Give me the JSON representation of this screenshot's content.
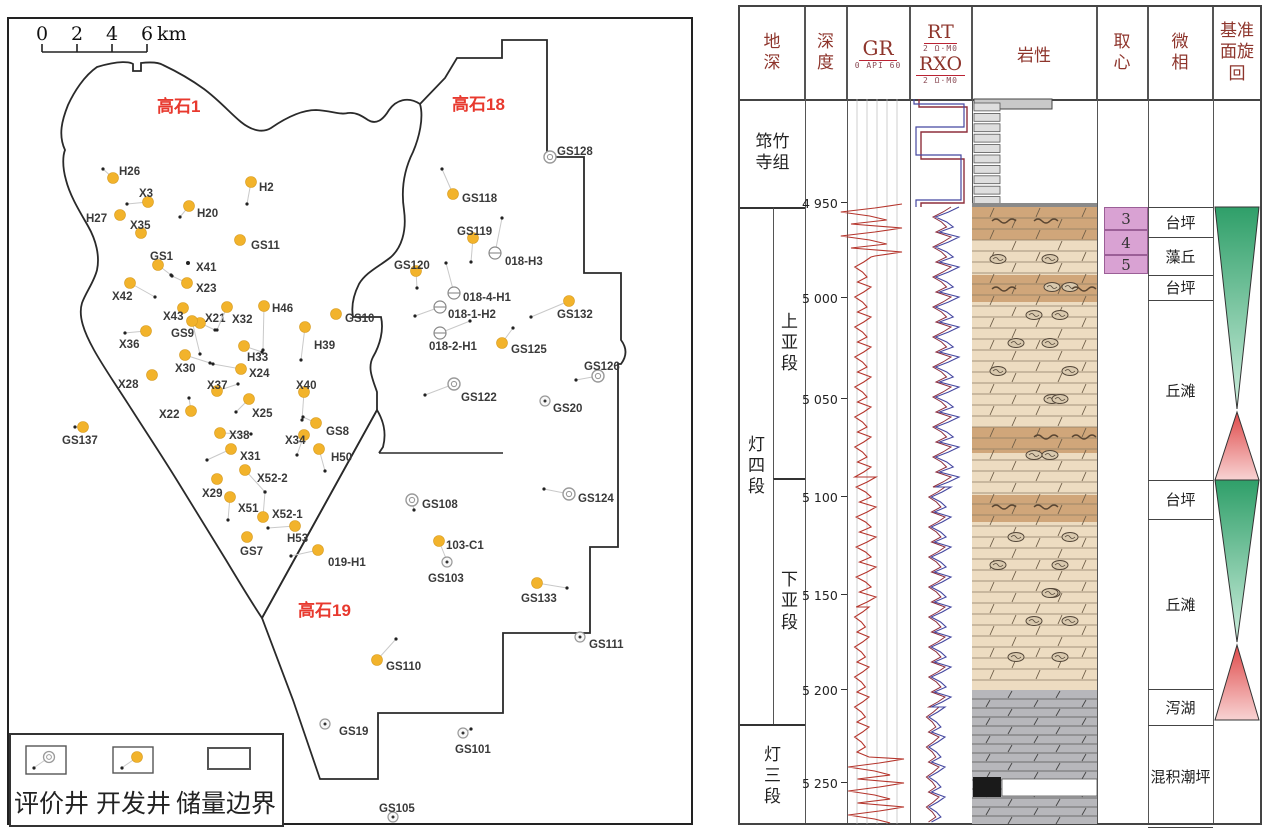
{
  "map": {
    "scalebar": {
      "labels": [
        "0",
        "2",
        "4",
        "6"
      ],
      "unit": "km",
      "tick_xs": [
        42,
        77,
        112,
        147
      ]
    },
    "areas": [
      {
        "label": "高石1",
        "x": 157,
        "y": 112
      },
      {
        "label": "高石18",
        "x": 452,
        "y": 110
      },
      {
        "label": "高石19",
        "x": 298,
        "y": 616
      }
    ],
    "area_color": "#e8392e",
    "boundaries": {
      "west_blob": "M 97,67 C 120,60 130,62 133,64 L 133,71 L 141,71 L 141,63 C 150,62 158,62 163,65 C 180,73 193,81 204,89 C 220,101 230,113 241,122 C 252,131 263,133 271,128 C 284,119 301,110 316,110 C 332,111 341,115 348,113 C 356,112 362,116 368,120 C 376,125 383,120 389,110 C 396,100 408,96 420,104 C 424,118 419,138 413,152 C 404,170 401,190 404,210 C 407,232 401,248 391,257 C 380,266 366,272 359,284 C 354,294 351,306 353,317 L 381,317 C 384,330 380,345 373,357 C 367,368 373,380 377,392 L 377,410 L 262,618 C 250,600 238,580 226,560 C 210,534 194,508 178,482 C 162,456 146,432 132,410 C 118,388 104,368 94,350 C 84,332 78,316 82,303 C 86,292 94,282 97,270 C 100,256 96,240 88,226 C 80,212 70,196 66,180 C 62,166 63,155 65,150 C 58,135 62,120 68,105 C 74,92 84,76 97,67 Z",
      "east_blocks": "M 420,104 L 445,78 L 457,58 L 502,58 L 502,40 L 547,40 L 547,157 L 584,157 L 584,273 L 621,273 L 621,340 Q 630,352 621,364 L 618,364 L 618,547 L 590,547 L 590,633 L 503,633 L 503,713 L 378,713 L 378,779 L 320,779 L 293,700 L 262,618 L 377,410 Q 388,428 383,447 L 379,453",
      "divider": "M 379,453 L 503,453"
    },
    "legend": {
      "items": [
        {
          "label": "评价井",
          "type": "a"
        },
        {
          "label": "开发井",
          "type": "d"
        },
        {
          "label": "储量边界",
          "type": "b"
        }
      ]
    },
    "wells_format": "[name, type(d=development-orange, a=appraisal-circle, c=circle-dot, h=horizontal-well, p=planned-dot), x, y, labelX, labelY, bottomholeX, bottomholeY]",
    "wells": [
      [
        "H26",
        "d",
        113,
        178,
        119,
        171,
        103,
        169
      ],
      [
        "X3",
        "d",
        148,
        202,
        139,
        193,
        127,
        204
      ],
      [
        "H2",
        "d",
        251,
        182,
        259,
        187,
        247,
        204
      ],
      [
        "H27",
        "d",
        120,
        215,
        86,
        218,
        null,
        null
      ],
      [
        "H20",
        "d",
        189,
        206,
        197,
        213,
        180,
        217
      ],
      [
        "X35",
        "d",
        141,
        233,
        130,
        225,
        null,
        null
      ],
      [
        "GS11",
        "d",
        240,
        240,
        251,
        245,
        null,
        null
      ],
      [
        "GS1",
        "d",
        158,
        265,
        150,
        256,
        171,
        275
      ],
      [
        "X41",
        "p",
        188,
        263,
        196,
        267,
        null,
        null
      ],
      [
        "X23",
        "d",
        187,
        283,
        196,
        288,
        172,
        276
      ],
      [
        "X42",
        "d",
        130,
        283,
        112,
        296,
        155,
        297
      ],
      [
        "X43",
        "d",
        183,
        308,
        163,
        316,
        null,
        null
      ],
      [
        "X21",
        "d",
        200,
        323,
        205,
        318,
        215,
        330
      ],
      [
        "X32",
        "d",
        227,
        307,
        232,
        319,
        217,
        330
      ],
      [
        "H46",
        "d",
        264,
        306,
        272,
        308,
        263,
        350
      ],
      [
        "GS10",
        "d",
        336,
        314,
        345,
        318,
        null,
        null
      ],
      [
        "GS9",
        "d",
        192,
        321,
        171,
        333,
        200,
        354
      ],
      [
        "X36",
        "d",
        146,
        331,
        119,
        344,
        125,
        333
      ],
      [
        "H39",
        "d",
        305,
        327,
        314,
        345,
        301,
        360
      ],
      [
        "X30",
        "d",
        185,
        355,
        175,
        368,
        210,
        363
      ],
      [
        "H33",
        "d",
        244,
        346,
        247,
        357,
        262,
        352
      ],
      [
        "X24",
        "d",
        241,
        369,
        249,
        373,
        213,
        364
      ],
      [
        "X28",
        "d",
        152,
        375,
        118,
        384,
        null,
        null
      ],
      [
        "X37",
        "d",
        217,
        391,
        207,
        385,
        238,
        384
      ],
      [
        "X40",
        "d",
        304,
        392,
        296,
        385,
        302,
        420
      ],
      [
        "X22",
        "d",
        191,
        411,
        159,
        414,
        189,
        398
      ],
      [
        "X25",
        "d",
        249,
        399,
        252,
        413,
        236,
        412
      ],
      [
        "GS8",
        "d",
        316,
        423,
        326,
        431,
        303,
        417
      ],
      [
        "X38",
        "d",
        220,
        433,
        229,
        435,
        251,
        434
      ],
      [
        "X34",
        "d",
        304,
        435,
        285,
        440,
        297,
        455
      ],
      [
        "H50",
        "d",
        319,
        449,
        331,
        457,
        325,
        471
      ],
      [
        "X31",
        "d",
        231,
        449,
        240,
        456,
        207,
        460
      ],
      [
        "X52-2",
        "d",
        245,
        470,
        257,
        478,
        265,
        492
      ],
      [
        "X29",
        "d",
        217,
        479,
        202,
        493,
        null,
        null
      ],
      [
        "X51",
        "d",
        230,
        497,
        238,
        508,
        228,
        520
      ],
      [
        "X52-1",
        "d",
        263,
        517,
        272,
        514,
        265,
        492
      ],
      [
        "H53",
        "d",
        295,
        526,
        287,
        538,
        268,
        528
      ],
      [
        "GS7",
        "d",
        247,
        537,
        240,
        551,
        null,
        null
      ],
      [
        "019-H1",
        "d",
        318,
        550,
        328,
        562,
        291,
        556
      ],
      [
        "GS137",
        "d",
        83,
        427,
        62,
        440,
        75,
        427
      ],
      [
        "GS128",
        "a",
        550,
        157,
        557,
        151,
        null,
        null
      ],
      [
        "GS118",
        "d",
        453,
        194,
        462,
        198,
        442,
        169
      ],
      [
        "GS119",
        "d",
        473,
        238,
        457,
        231,
        471,
        262
      ],
      [
        "018-H3",
        "h",
        495,
        253,
        505,
        261,
        502,
        218
      ],
      [
        "GS120",
        "d",
        416,
        271,
        394,
        265,
        417,
        288
      ],
      [
        "018-4-H1",
        "h",
        454,
        293,
        463,
        297,
        446,
        263
      ],
      [
        "018-1-H2",
        "h",
        440,
        307,
        448,
        314,
        415,
        316
      ],
      [
        "018-2-H1",
        "h",
        440,
        333,
        429,
        346,
        470,
        321
      ],
      [
        "GS132",
        "d",
        569,
        301,
        557,
        314,
        531,
        317
      ],
      [
        "GS125",
        "d",
        502,
        343,
        511,
        349,
        513,
        328
      ],
      [
        "GS126",
        "a",
        598,
        376,
        584,
        366,
        576,
        380
      ],
      [
        "GS122",
        "a",
        454,
        384,
        461,
        397,
        425,
        395
      ],
      [
        "GS20",
        "c",
        545,
        401,
        553,
        408,
        null,
        null
      ],
      [
        "GS124",
        "a",
        569,
        494,
        578,
        498,
        544,
        489
      ],
      [
        "GS108",
        "a",
        412,
        500,
        422,
        504,
        414,
        510
      ],
      [
        "103-C1",
        "d",
        439,
        541,
        446,
        545,
        447,
        561
      ],
      [
        "GS103",
        "c",
        447,
        562,
        428,
        578,
        null,
        null
      ],
      [
        "GS133",
        "d",
        537,
        583,
        521,
        598,
        567,
        588
      ],
      [
        "GS111",
        "c",
        580,
        637,
        589,
        644,
        null,
        null
      ],
      [
        "GS110",
        "d",
        377,
        660,
        386,
        666,
        396,
        639
      ],
      [
        "GS19",
        "c",
        325,
        724,
        339,
        731,
        null,
        null
      ],
      [
        "GS101",
        "c",
        463,
        733,
        455,
        749,
        471,
        729
      ],
      [
        "GS105",
        "c",
        393,
        817,
        379,
        808,
        null,
        null
      ]
    ],
    "dev_color": "#f2b32b"
  },
  "log": {
    "headers": {
      "col1": "地深",
      "col2": "深度",
      "gr": "GR",
      "gr_scale": "0 API 60",
      "rt": "RT",
      "rt_scale": "2 Ω·M0",
      "rxo": "RXO",
      "rxo_scale": "2 Ω·M0",
      "lith": "岩性",
      "core": "取心",
      "facies": "微相",
      "cycle": "基准面旋回"
    },
    "formation_cells": [
      [
        "筇竹寺组",
        0,
        92,
        65,
        108,
        "w"
      ],
      [
        "灯四段",
        0,
        200,
        33,
        517,
        "v"
      ],
      [
        "上亚段",
        33,
        200,
        32,
        271,
        "v"
      ],
      [
        "下亚段",
        33,
        471,
        32,
        246,
        "v"
      ],
      [
        "灯三段",
        0,
        717,
        65,
        103,
        "v"
      ]
    ],
    "depth_ticks": [
      [
        "4 950",
        196
      ],
      [
        "5 000",
        291
      ],
      [
        "5 050",
        392
      ],
      [
        "5 100",
        490
      ],
      [
        "5 150",
        588
      ],
      [
        "5 200",
        683
      ],
      [
        "5 250",
        776
      ]
    ],
    "core_boxes": [
      [
        "3",
        200,
        23
      ],
      [
        "4",
        223,
        25
      ],
      [
        "5",
        248,
        19
      ]
    ],
    "facies_cells": [
      [
        "台坪",
        200,
        30
      ],
      [
        "藻丘",
        230,
        38
      ],
      [
        "台坪",
        268,
        25
      ],
      [
        "丘滩",
        293,
        180
      ],
      [
        "台坪",
        473,
        39
      ],
      [
        "丘滩",
        512,
        170
      ],
      [
        "泻湖",
        682,
        36
      ],
      [
        "混积潮坪",
        718,
        102
      ]
    ],
    "cycles": [
      {
        "taper": "down",
        "ytop": 200,
        "ybot": 402,
        "c1": "#2f9f69",
        "c2": "#cdeedd"
      },
      {
        "taper": "up",
        "ytop": 405,
        "ybot": 473,
        "c1": "#df4a4a",
        "c2": "#f8d3d3"
      },
      {
        "taper": "down",
        "ytop": 473,
        "ybot": 635,
        "c1": "#2f9f69",
        "c2": "#cdeedd"
      },
      {
        "taper": "up",
        "ytop": 638,
        "ybot": 713,
        "c1": "#df4a4a",
        "c2": "#f8d3d3"
      }
    ],
    "lith": {
      "x": 232,
      "w": 125,
      "strip": {
        "x": 234,
        "w": 26,
        "y0": 92,
        "y1": 200,
        "n": 10
      },
      "topbox": {
        "x": 234,
        "w": 78,
        "y": 92,
        "h": 10
      },
      "tan": {
        "y": 200,
        "h": 483,
        "fill": "#eddcc1"
      },
      "bands": [
        [
          200,
          33
        ],
        [
          268,
          27
        ],
        [
          420,
          26
        ],
        [
          488,
          27
        ]
      ],
      "band_fill": "#d0a67a",
      "gray": {
        "y": 683,
        "h": 137,
        "fill": "#b7b7bb"
      },
      "white_band": {
        "x": 262,
        "y": 772,
        "w": 95,
        "h": 17
      },
      "black_box": {
        "x": 233,
        "y": 770,
        "w": 28,
        "h": 20
      },
      "oncolite_rows": [
        252,
        280,
        308,
        336,
        364,
        392,
        448,
        530,
        558,
        586,
        614,
        650
      ],
      "wavy_rows": [
        214,
        282,
        430,
        500
      ]
    },
    "curves": {
      "gr_color": "#b5352c",
      "rt_color": "#4547a0",
      "rxo_color": "#8e2f3c",
      "gr_segments": [
        [
          197,
          250,
          128,
          34,
          4
        ],
        [
          250,
          470,
          122,
          9,
          5
        ],
        [
          470,
          600,
          125,
          11,
          5
        ],
        [
          600,
          752,
          121,
          8,
          5
        ],
        [
          752,
          818,
          133,
          31,
          4
        ]
      ],
      "rt_top": [
        [
          174,
          92
        ],
        [
          174,
          97
        ],
        [
          224,
          97
        ],
        [
          224,
          120
        ],
        [
          176,
          120
        ],
        [
          176,
          148
        ],
        [
          221,
          148
        ],
        [
          221,
          193
        ],
        [
          176,
          193
        ],
        [
          176,
          200
        ]
      ],
      "rxo_top": [
        [
          179,
          92
        ],
        [
          179,
          100
        ],
        [
          227,
          100
        ],
        [
          227,
          125
        ],
        [
          181,
          125
        ],
        [
          181,
          152
        ],
        [
          224,
          152
        ],
        [
          224,
          196
        ],
        [
          181,
          196
        ],
        [
          181,
          200
        ]
      ],
      "rt_segments": [
        [
          200,
          480,
          206,
          13,
          5
        ],
        [
          480,
          700,
          200,
          11,
          5
        ],
        [
          700,
          818,
          196,
          9,
          5
        ]
      ],
      "rxo_segments": [
        [
          200,
          480,
          201,
          10,
          5
        ],
        [
          480,
          700,
          196,
          9,
          5
        ],
        [
          700,
          818,
          192,
          7,
          5
        ]
      ]
    }
  }
}
